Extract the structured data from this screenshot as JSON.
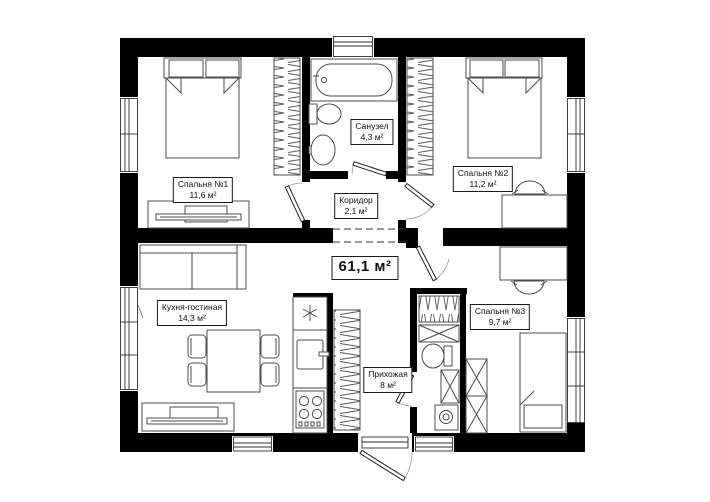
{
  "plan": {
    "total_area": "61,1 м²",
    "rooms": [
      {
        "name": "Спальня №1",
        "area": "11,6 м²"
      },
      {
        "name": "Санузел",
        "area": "4,3 м²"
      },
      {
        "name": "Спальня №2",
        "area": "11,2 м²"
      },
      {
        "name": "Коридор",
        "area": "2,1 м²"
      },
      {
        "name": "Кухня-гостиная",
        "area": "14,3 м²"
      },
      {
        "name": "Прихожая",
        "area": "8 м²"
      },
      {
        "name": "Спальня №3",
        "area": "9,7 м²"
      }
    ],
    "colors": {
      "wall": "#000000",
      "furniture_line": "#4d4d4d",
      "background": "#ffffff"
    }
  }
}
